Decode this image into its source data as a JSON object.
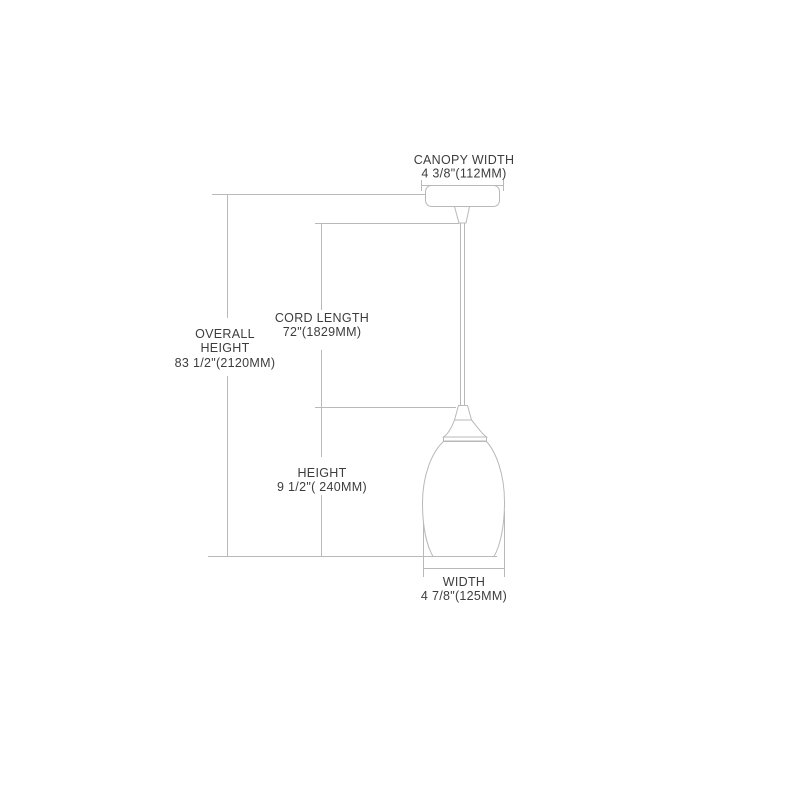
{
  "diagram": {
    "kind": "pendant-light-dimension-drawing",
    "colors": {
      "line": "#b9b9b9",
      "text": "#3d3d3d",
      "background": "#ffffff"
    },
    "dimensions": {
      "canopy_width": {
        "label": "CANOPY WIDTH",
        "value": "4 3/8\"(112MM)"
      },
      "overall_height": {
        "label_line1": "OVERALL",
        "label_line2": "HEIGHT",
        "value": "83 1/2\"(2120MM)"
      },
      "cord_length": {
        "label": "CORD LENGTH",
        "value": "72\"(1829MM)"
      },
      "height": {
        "label": "HEIGHT",
        "value": "9 1/2\"( 240MM)"
      },
      "width": {
        "label": "WIDTH",
        "value": "4 7/8\"(125MM)"
      }
    }
  }
}
